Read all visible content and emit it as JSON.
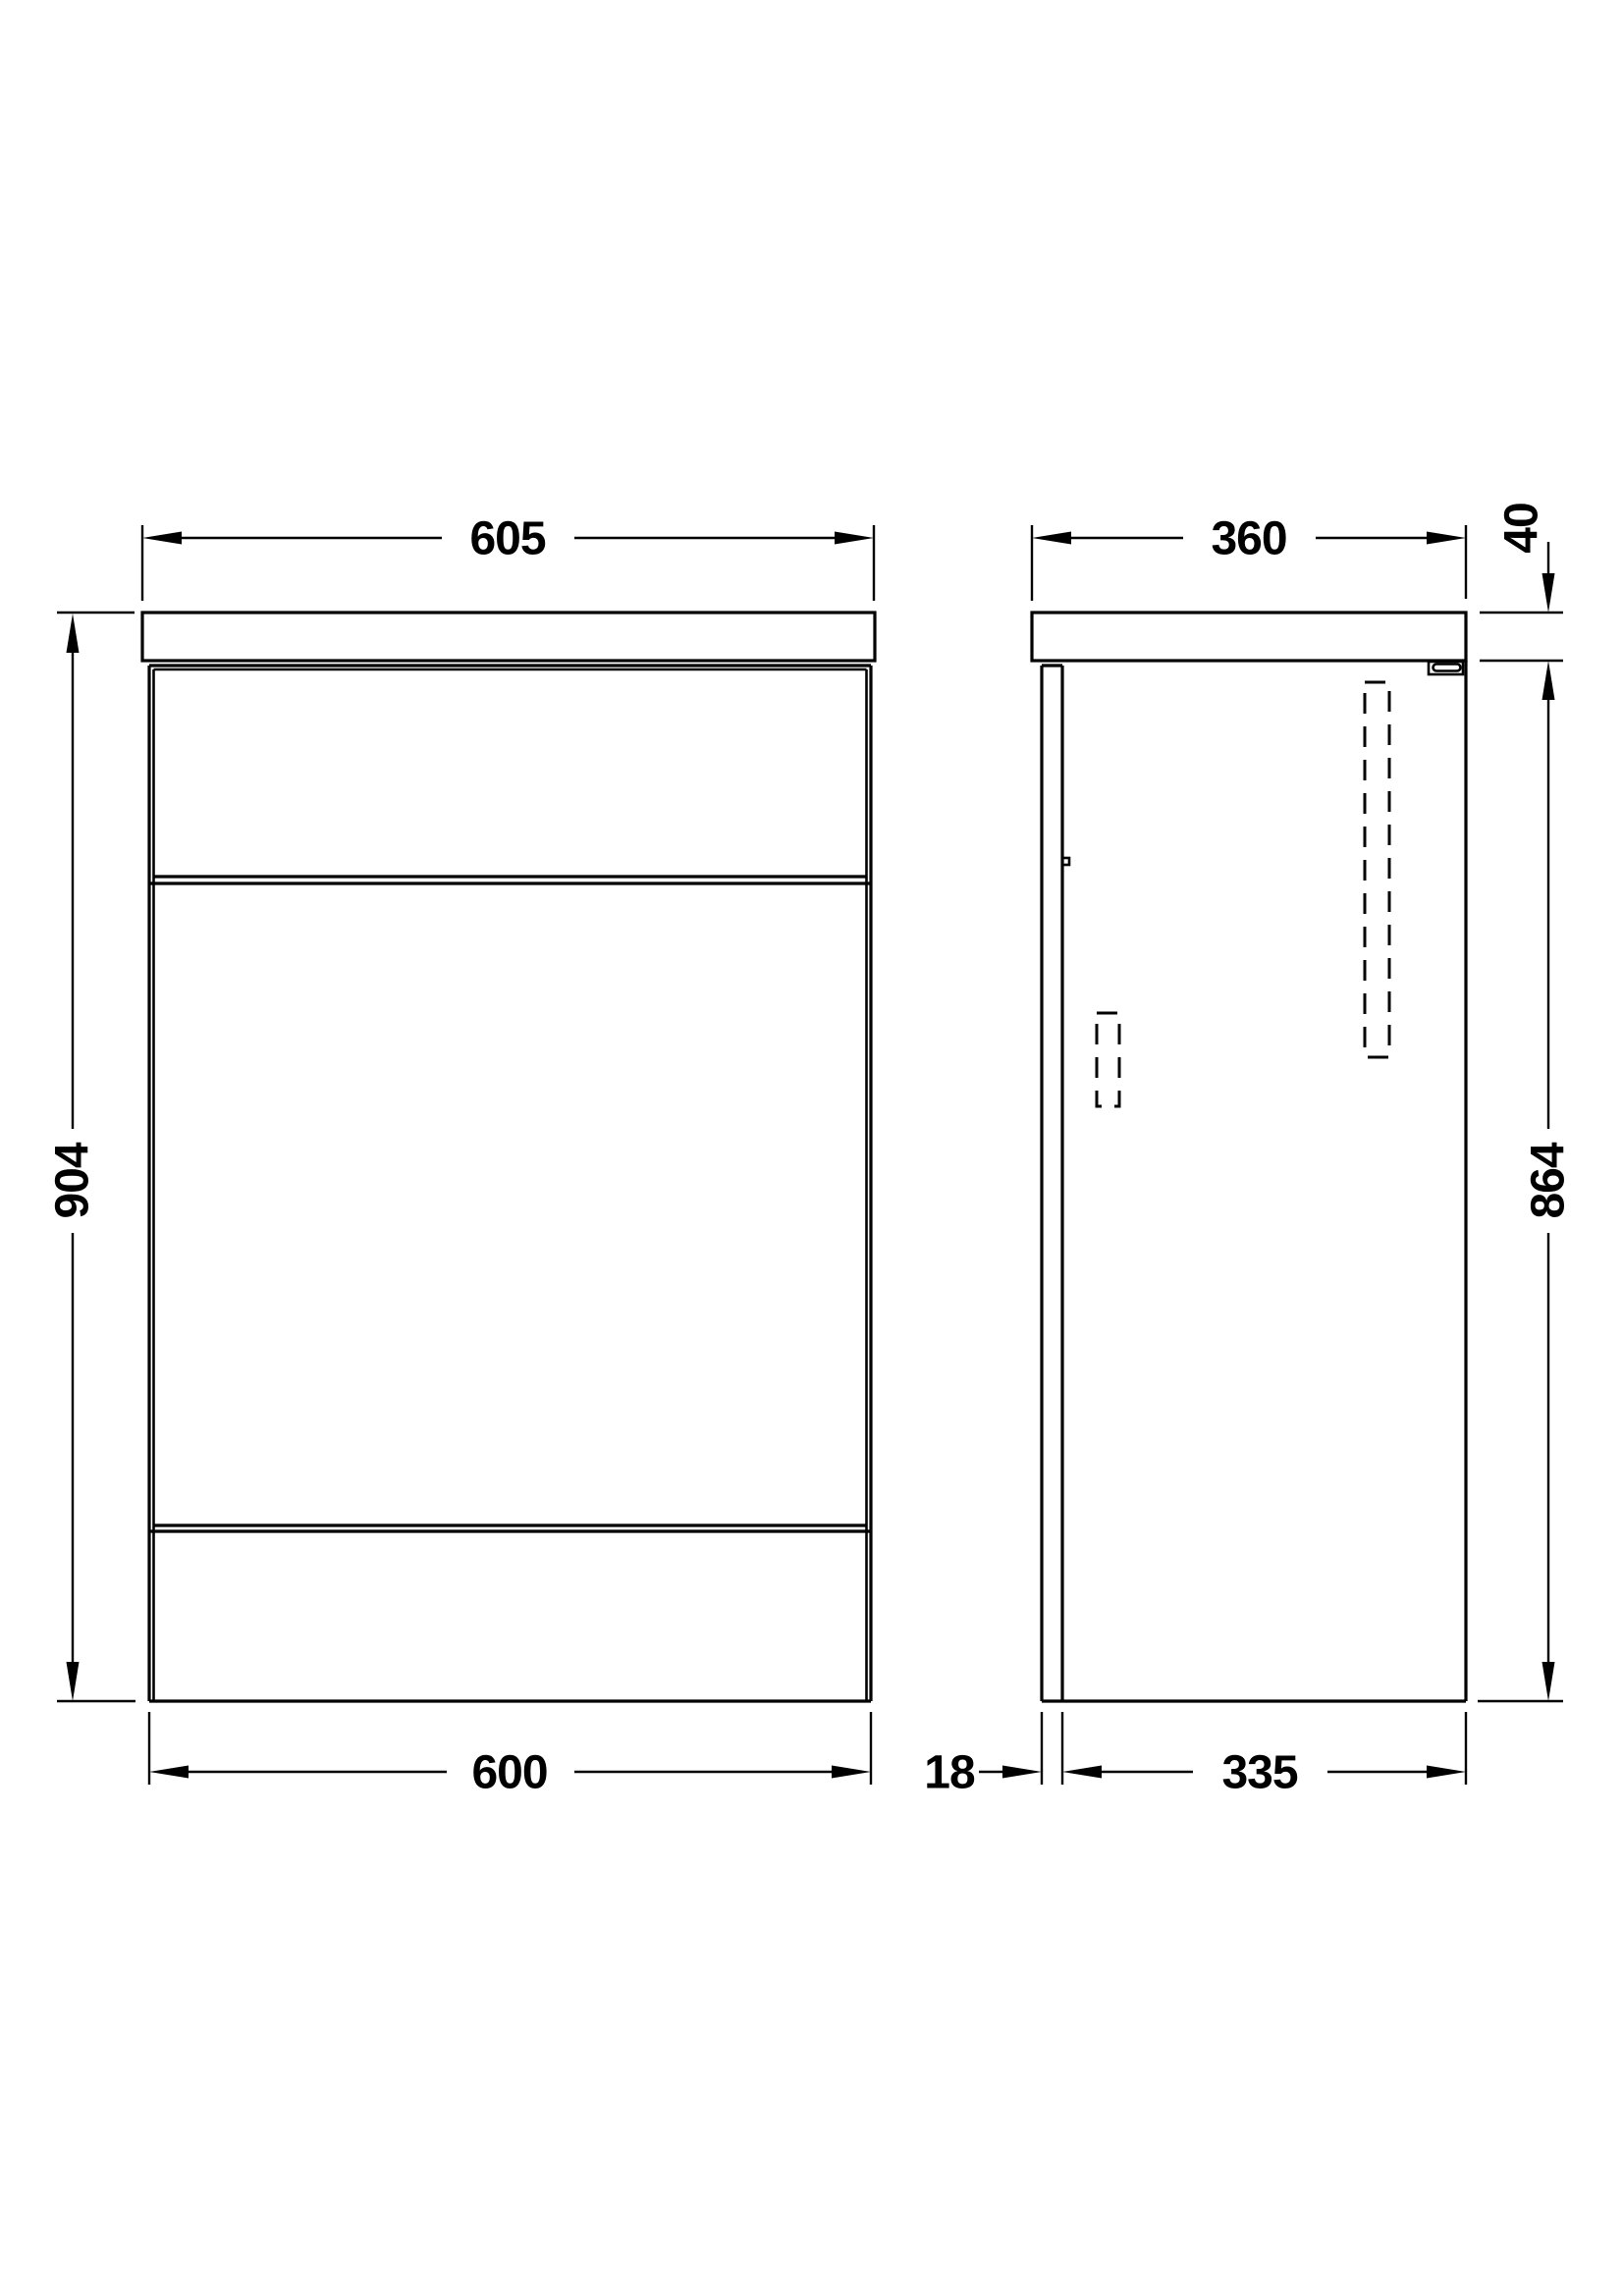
{
  "drawing": {
    "front_view": {
      "width_top": "605",
      "height": "904",
      "width_bottom": "600"
    },
    "side_view": {
      "depth": "360",
      "worktop_thickness": "40",
      "cabinet_height": "864",
      "front_panel_thickness": "18",
      "cabinet_depth": "335"
    }
  }
}
